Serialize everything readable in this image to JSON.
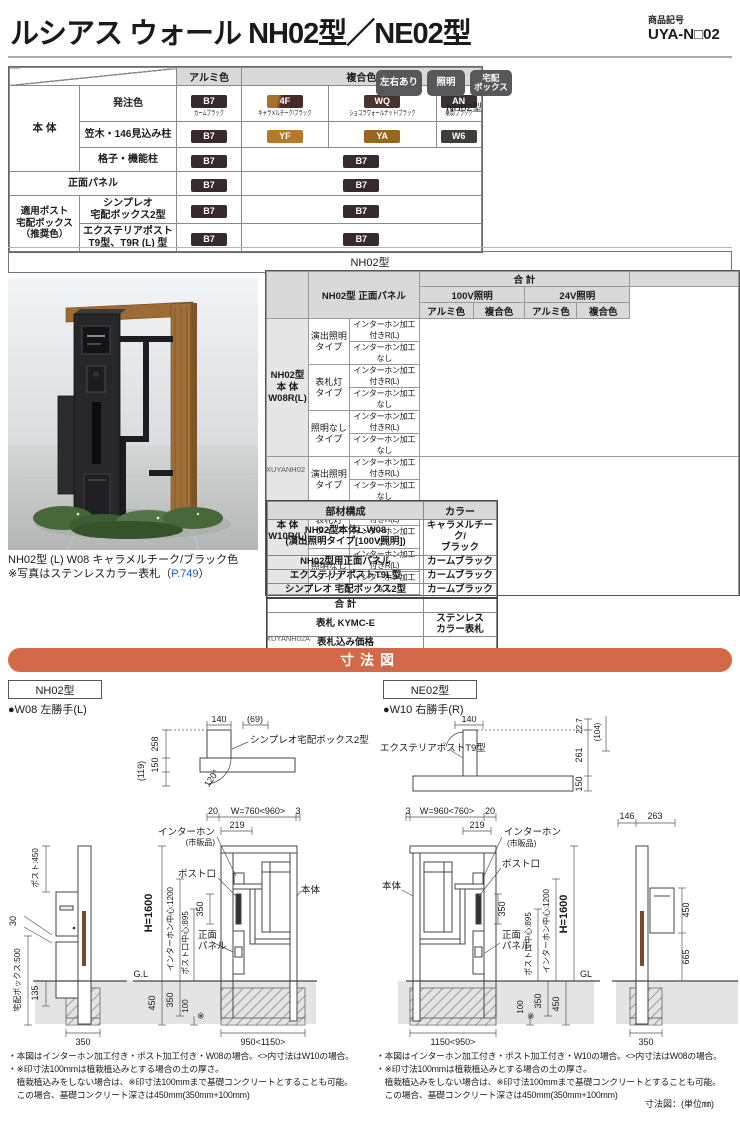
{
  "header": {
    "title": "ルシアス ウォール NH02型／NE02型",
    "code_label": "商品記号",
    "code": "UYA-N□02"
  },
  "badges": {
    "b1": "左右あり",
    "b2": "照明",
    "b3": "宅配\nボックス",
    "model": "NH02型"
  },
  "color_table": {
    "h_alumi": "アルミ色",
    "h_fukugo": "複合色",
    "g_hontai": "本 体",
    "g_post": "適用ポスト\n宅配ボックス\n（推奨色）",
    "r1": "発注色",
    "r2": "笠木・146見込み柱",
    "r3": "格子・機能柱",
    "r4": "正面パネル",
    "r5": "シンプレオ\n宅配ボックス2型",
    "r6": "エクステリアポスト\nT9型、T9R (L) 型",
    "chips": {
      "b7": {
        "code": "B7",
        "name": "カームブラック",
        "css": "background:#382a2c"
      },
      "f4": {
        "code": "4F",
        "name": "キャラメルチーク/ブラック",
        "css": "background:linear-gradient(100deg,#a8702c 0%,#a8702c 30%,#45292b 42%,#45292b 100%)"
      },
      "wq": {
        "code": "WQ",
        "name": "ショコラウォールナット/ブラック",
        "css": "background:#4a332e"
      },
      "an": {
        "code": "AN",
        "name": "桑炭/ブラック",
        "css": "background:#3a3134"
      },
      "yf": {
        "code": "YF",
        "css": "background:#b5792b"
      },
      "ya": {
        "code": "YA",
        "css": "background:#9a661e"
      },
      "w6": {
        "code": "W6",
        "css": "background:#403d37"
      }
    }
  },
  "nh02_section": {
    "title": "NH02型",
    "caption1": "NH02型 (L) W08 キャラメルチーク/ブラック色",
    "caption2_pre": "※写真はステンレスカラー表札（",
    "caption2_link": "P.749",
    "caption2_post": "）",
    "code": "XUYANH02",
    "code2": "XUYANH02A"
  },
  "price_table": {
    "corner": "NH02型 正面パネル",
    "total": "合 計",
    "v100": "100V照明",
    "v24": "24V照明",
    "alumi": "アルミ色",
    "fukugo": "複合色",
    "g1": "NH02型\n本 体\nW08R(L)",
    "g2": "NH02型\n本 体\nW10R(L)",
    "t1": "演出照明\nタイプ",
    "t2": "表札灯\nタイプ",
    "t3": "照明なし\nタイプ",
    "va": "インターホン加工付きR(L)",
    "vb": "インターホン加工なし"
  },
  "parts_table": {
    "h1": "部材構成",
    "h2": "カラー",
    "rows": [
      {
        "item": "NH02型本体L-W08\n(演出照明タイプ[100V照明])",
        "color": "キャラメルチーク/\nブラック"
      },
      {
        "item": "NH02型用正面パネル",
        "color": "カームブラック"
      },
      {
        "item": "エクステリアポストT9L型",
        "color": "カームブラック"
      },
      {
        "item": "シンプレオ 宅配ボックス2型",
        "color": "カームブラック"
      },
      {
        "item": "合 計",
        "color": ""
      },
      {
        "item": "表札 KYMC-E",
        "color": "ステンレス\nカラー表札"
      },
      {
        "item": "表札込み価格",
        "color": ""
      }
    ]
  },
  "dim": {
    "bar": "寸法図",
    "unit": "寸法図：(単位㎜)",
    "nh02": {
      "model": "NH02型",
      "variant": "●W08 左勝手(L)",
      "plan": {
        "d140": "140",
        "d69": "(69)",
        "d258": "258",
        "d150": "150",
        "d119": "(119)",
        "deg": "120°",
        "box": "シンプレオ宅配ボックス2型"
      },
      "row": {
        "d20": "20",
        "w": "W=760<960>",
        "d3": "3",
        "d219": "219"
      },
      "elev": {
        "iphone": "インターホン",
        "iphone2": "(市販品)",
        "slot": "ポスト口",
        "body": "本体",
        "h": "H=1600",
        "ic": "インターホン中心:1200",
        "pc": "ポスト口中心:895",
        "d350": "350",
        "p1": "正面",
        "p2": "パネル",
        "gl": "G.L",
        "g450": "450",
        "g350": "350",
        "g100": "100",
        "ast": "※",
        "bottom": "950<1150>"
      },
      "side": {
        "post450": "ポスト:450",
        "d30": "30",
        "box500": "宅配ボックス:500",
        "d135": "135",
        "d350": "350"
      },
      "notes": [
        "・本図はインターホン加工付き・ポスト加工付き・W08の場合。<>内寸法はW10の場合。",
        "・※印寸法100mmは植栽植込みとする場合の土の厚さ。",
        "　植栽植込みをしない場合は、※印寸法100mmまで基礎コンクリートとすることも可能。",
        "　この場合、基礎コンクリート深さは450mm(350mm+100mm)"
      ]
    },
    "ne02": {
      "model": "NE02型",
      "variant": "●W10 右勝手(R)",
      "plan": {
        "d140": "140",
        "d227": "22.7",
        "d104": "(104)",
        "d261": "261",
        "d150": "150",
        "box": "エクステリアポストT9型"
      },
      "row": {
        "d3": "3",
        "w": "W=960<760>",
        "d20": "20",
        "d219": "219"
      },
      "elev": {
        "iphone": "インターホン",
        "iphone2": "(市販品)",
        "slot": "ポスト口",
        "body": "本体",
        "h": "H=1600",
        "ic": "インターホン中心:1200",
        "pc": "ポスト口中心:895",
        "d350": "350",
        "p1": "正面",
        "p2": "パネル",
        "gl": "GL",
        "g450": "450",
        "g350": "350",
        "g100": "100",
        "ast": "※",
        "bottom": "1150<950>"
      },
      "side": {
        "d146": "146",
        "d263": "263",
        "d450": "450",
        "d665": "665",
        "d350": "350"
      },
      "notes": [
        "・本図はインターホン加工付き・ポスト加工付き・W10の場合。<>内寸法はW08の場合。",
        "・※印寸法100mmは植栽植込みとする場合の土の厚さ。",
        "　植栽植込みをしない場合は、※印寸法100mmまで基礎コンクリートとすることも可能。",
        "　この場合、基礎コンクリート深さは450mm(350mm+100mm)"
      ]
    }
  }
}
